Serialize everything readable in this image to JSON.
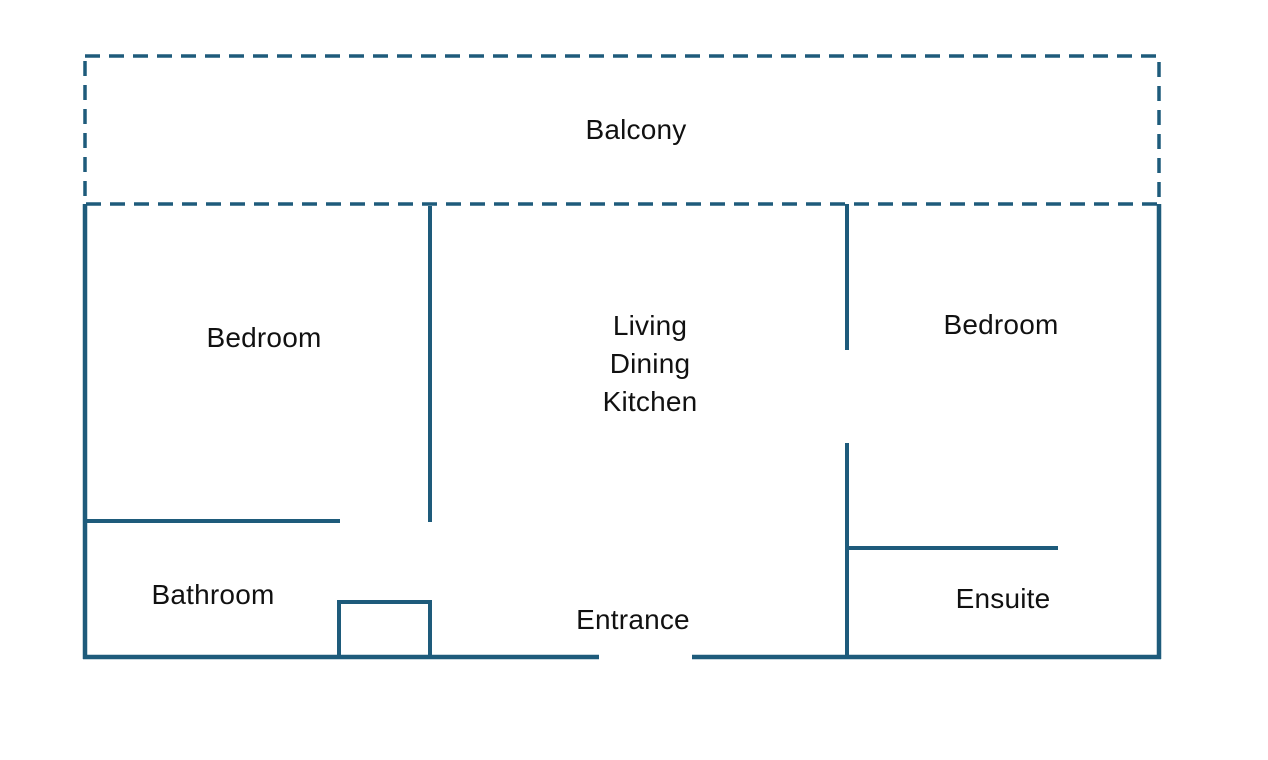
{
  "colors": {
    "wall": "#1e5b7b",
    "label": "#111111",
    "background": "#ffffff"
  },
  "rooms": {
    "balcony": {
      "label": "Balcony"
    },
    "bedroom_left": {
      "label": "Bedroom"
    },
    "living_dining_kitchen": {
      "label": "Living\nDining\nKitchen"
    },
    "bedroom_right": {
      "label": "Bedroom"
    },
    "bathroom": {
      "label": "Bathroom"
    },
    "entrance": {
      "label": "Entrance"
    },
    "ensuite": {
      "label": "Ensuite"
    }
  }
}
